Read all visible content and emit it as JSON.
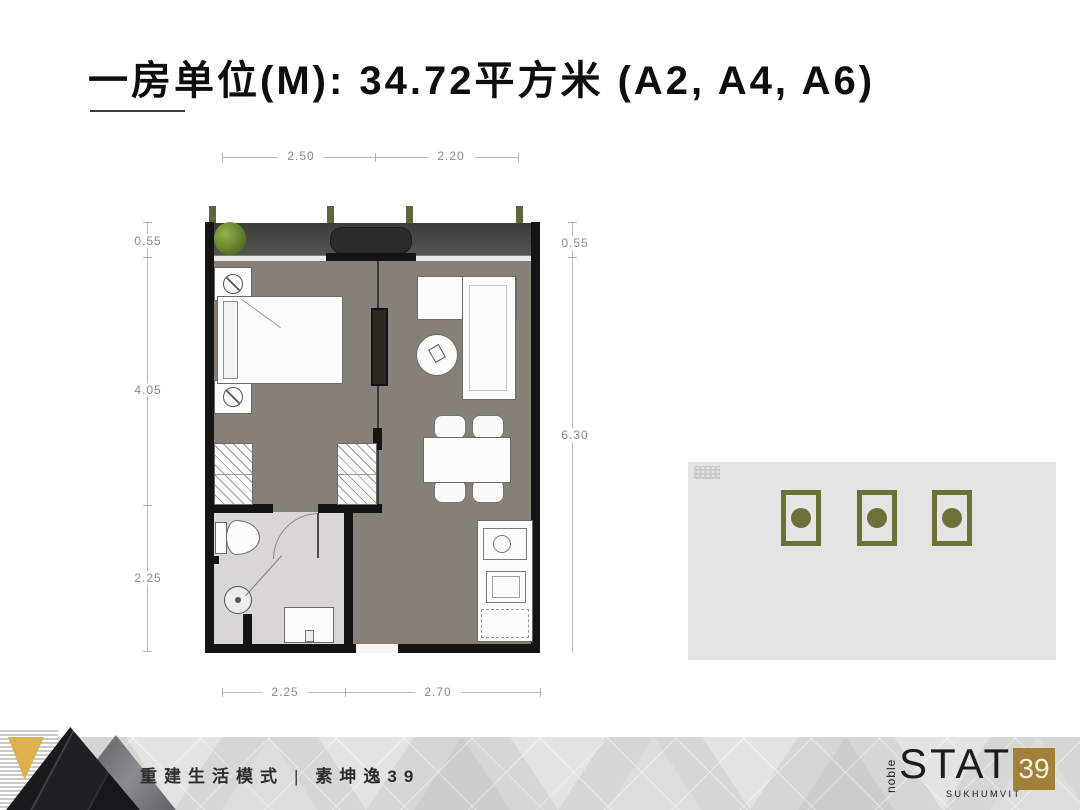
{
  "title": {
    "text": "一房单位(M): 34.72平方米 (A2, A4, A6)"
  },
  "floor_plan": {
    "dimensions": {
      "top": [
        "2.50",
        "2.20"
      ],
      "left": [
        "0.55",
        "4.05",
        "2.25"
      ],
      "right": [
        "0.55",
        "6.30"
      ],
      "bottom": [
        "2.25",
        "2.70"
      ]
    },
    "colors": {
      "wall": "#141414",
      "floor": "#868078",
      "bathroom_floor": "#d8d7d5",
      "balcony": "#454543",
      "plant": "#6d8a33"
    }
  },
  "locator": {
    "background": "#e4e4e2",
    "highlight_color": "#6b7139",
    "unit_count": 3
  },
  "footer": {
    "tagline": "重建生活模式",
    "separator": "|",
    "project": "素坤逸39",
    "logo": {
      "brand": "noble",
      "name": "STATE",
      "number": "39",
      "sub": "SUKHUMVIT",
      "badge_color": "#a3803a"
    }
  }
}
